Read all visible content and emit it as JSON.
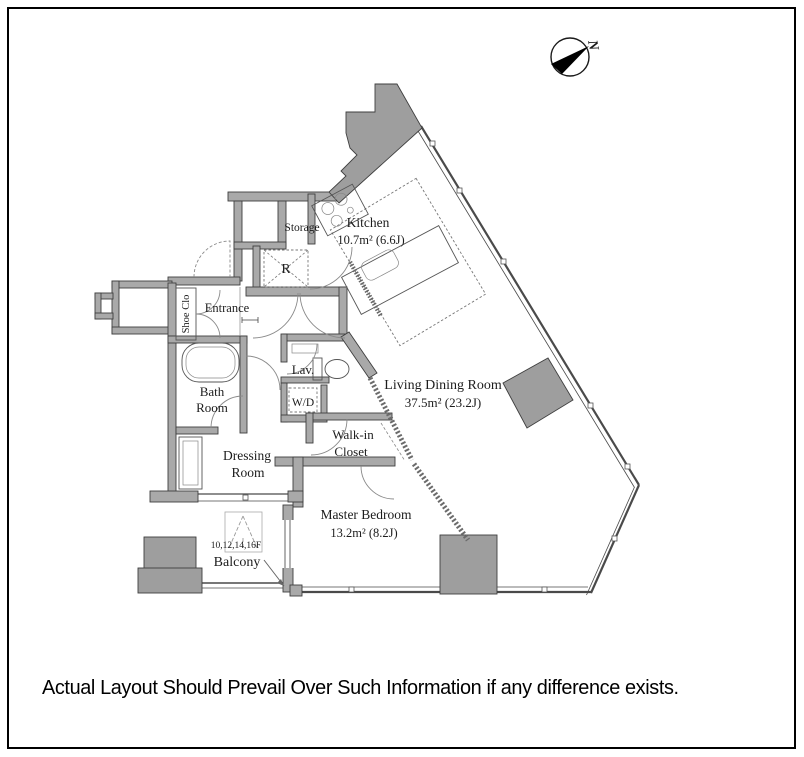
{
  "caption": "Actual Layout Should Prevail Over Such Information if any difference exists.",
  "compass": {
    "label": "N"
  },
  "colors": {
    "wall": "#a9a9a9",
    "pillar": "#9e9e9e",
    "outline": "#3f3f3f",
    "window_line": "#4a4a4a",
    "door_arc": "#8a8a8a",
    "hatch": "#6b6b6b",
    "text": "#1c1c1c",
    "background": "#ffffff",
    "frame": "#000000"
  },
  "rooms": {
    "kitchen": {
      "label": "Kitchen",
      "area": "10.7m² (6.6J)"
    },
    "living_dining": {
      "label": "Living Dining Room",
      "area": "37.5m² (23.2J)"
    },
    "master_bedroom": {
      "label": "Master Bedroom",
      "area": "13.2m² (8.2J)"
    },
    "storage": {
      "label": "Storage"
    },
    "entrance": {
      "label": "Entrance"
    },
    "shoe_closet": {
      "label": "Shoe Clo"
    },
    "bath_room": {
      "line1": "Bath",
      "line2": "Room"
    },
    "dressing_room": {
      "line1": "Dressing",
      "line2": "Room"
    },
    "lavatory": {
      "label": "Lav."
    },
    "washer_dryer": {
      "label": "W/D"
    },
    "walk_in_closet": {
      "line1": "Walk-in",
      "line2": "Closet"
    },
    "balcony": {
      "label": "Balcony",
      "floors": "10,12,14,16F"
    },
    "refrigerator": {
      "label": "R"
    }
  }
}
